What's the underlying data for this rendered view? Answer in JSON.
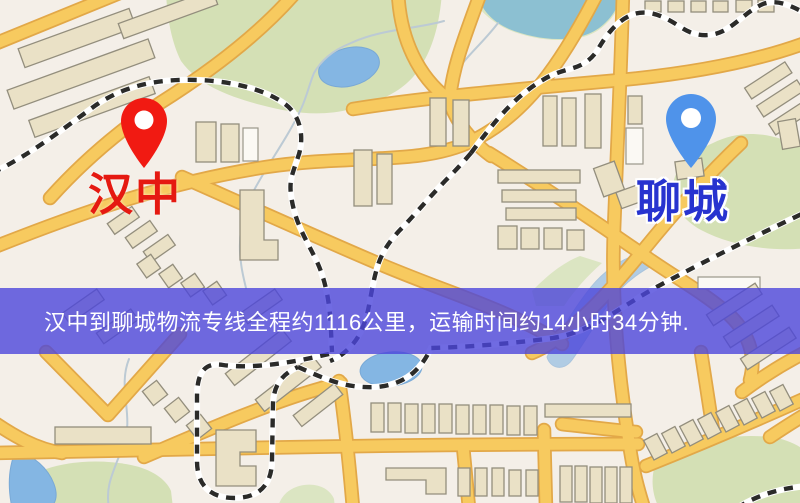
{
  "map": {
    "origin": {
      "label": "汉中",
      "pin_color": "#f11a12",
      "label_color": "#e51911"
    },
    "destination": {
      "label": "聊城",
      "pin_color": "#4f93ea",
      "label_color": "#2733cf"
    },
    "banner": {
      "text": "汉中到聊城物流专线全程约1116公里，运输时间约14小时34分钟.",
      "distance_km": "1116",
      "duration": "14小时34分钟",
      "bg_color": "rgba(76,70,219,0.8)",
      "text_color": "#ffffff"
    },
    "colors": {
      "background": "#f4efe8",
      "road_fill": "#f7ca5f",
      "road_edge": "#e2a848",
      "park": "#d4e0b5",
      "water": "#84b6e3",
      "building": "#eae1c6",
      "railway": "#2b2b29"
    }
  }
}
